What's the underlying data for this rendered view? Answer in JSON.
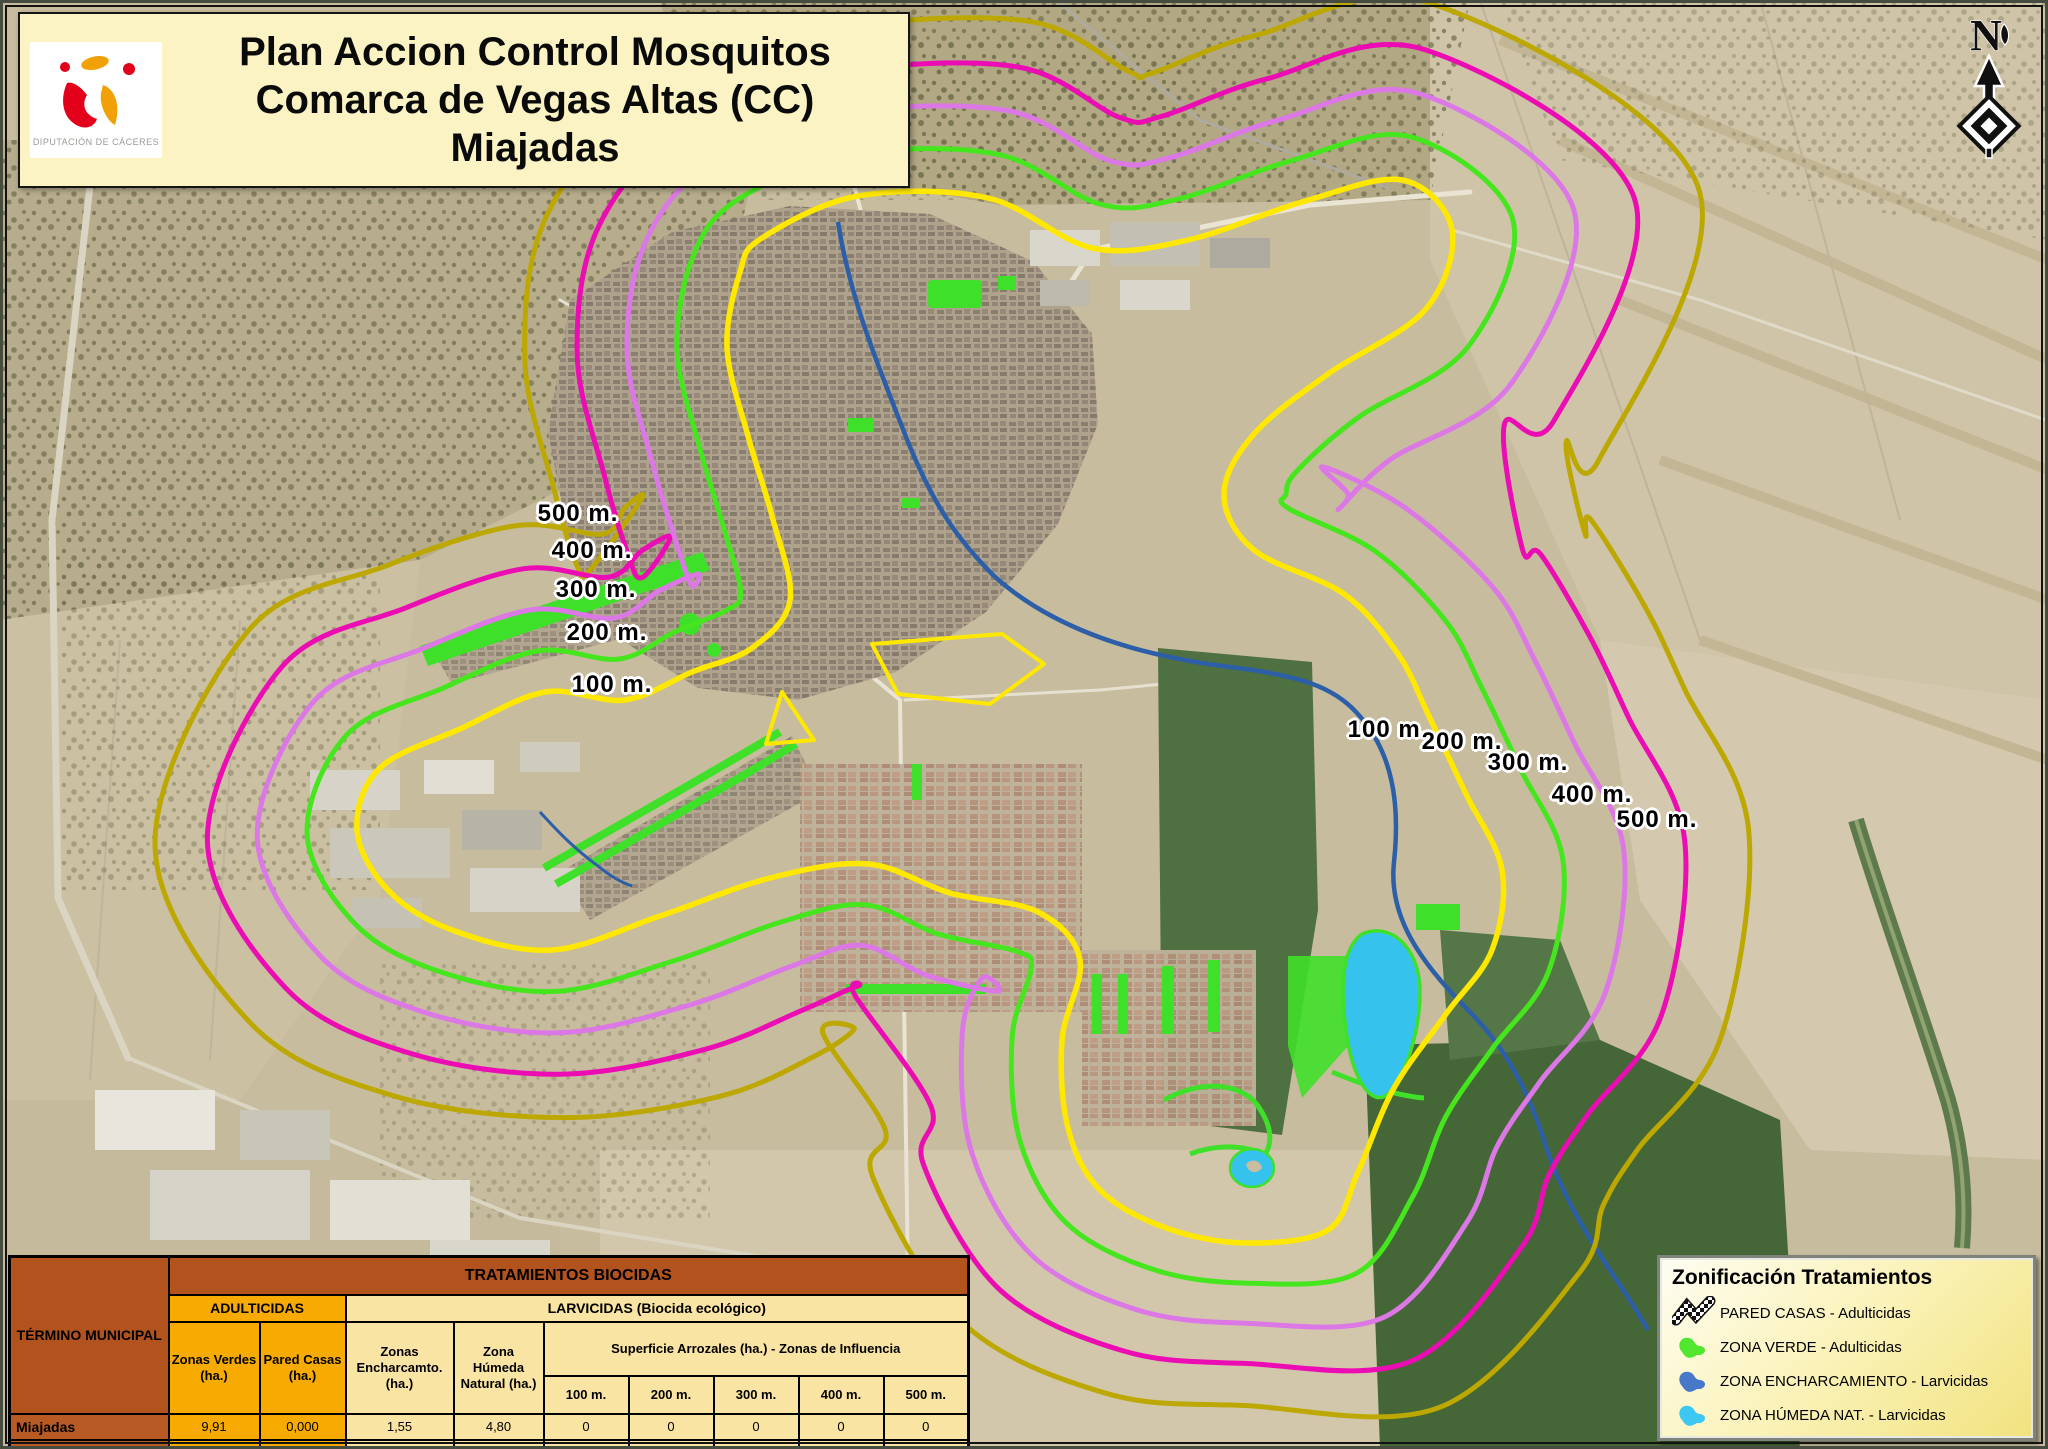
{
  "title_block": {
    "logo_caption": "DIPUTACIÓN DE CÁCERES",
    "line1": "Plan Accion Control Mosquitos",
    "line2": "Comarca de Vegas Altas (CC)",
    "line3": "Miajadas"
  },
  "north_arrow": {
    "label": "N"
  },
  "map": {
    "rings": [
      {
        "label": "100 m.",
        "color": "#FFE800",
        "offset": 0
      },
      {
        "label": "200 m.",
        "color": "#46E61E",
        "offset": 40
      },
      {
        "label": "300 m.",
        "color": "#DC78E6",
        "offset": 80
      },
      {
        "label": "400 m.",
        "color": "#EB0CB4",
        "offset": 120
      },
      {
        "label": "500 m.",
        "color": "#BCA800",
        "offset": 162
      }
    ],
    "left_labels": [
      "500 m.",
      "400 m.",
      "300 m.",
      "200 m.",
      "100 m."
    ],
    "right_labels": [
      "100 m.",
      "200 m.",
      "300 m.",
      "400 m.",
      "500 m."
    ],
    "features": {
      "river_color": "#2C5FA8",
      "lake_color": "#35C3EE",
      "green_zone_color": "#3FE02A"
    }
  },
  "legend": {
    "title": "Zonificación Tratamientos",
    "items": [
      {
        "icon": "checkered-flag-icon",
        "label": "PARED CASAS - Adulticidas",
        "color": "#111111"
      },
      {
        "icon": "green-zone-icon",
        "label": "ZONA VERDE - Adulticidas",
        "color": "#52E62E"
      },
      {
        "icon": "waterlogging-zone-icon",
        "label": "ZONA ENCHARCAMIENTO - Larvicidas",
        "color": "#4878C8"
      },
      {
        "icon": "wetland-zone-icon",
        "label": "ZONA HÚMEDA NAT. - Larvicidas",
        "color": "#3CC8F2"
      }
    ]
  },
  "table": {
    "row_header": "TÉRMINO MUNICIPAL",
    "main_header": "TRATAMIENTOS BIOCIDAS",
    "groups": {
      "adulticidas": "ADULTICIDAS",
      "larvicidas": "LARVICIDAS (Biocida ecológico)"
    },
    "columns": [
      "Zonas Verdes (ha.)",
      "Pared Casas (ha.)",
      "Zonas Encharcamto. (ha.)",
      "Zona Húmeda Natural (ha.)"
    ],
    "arrozales_header": "Superficie Arrozales (ha.) - Zonas de Influencia",
    "distance_columns": [
      "100 m.",
      "200 m.",
      "300 m.",
      "400 m.",
      "500 m."
    ],
    "rows": [
      {
        "municipality": "Miajadas",
        "values": [
          "9,91",
          "0,000",
          "1,55",
          "4,80",
          "0",
          "0",
          "0",
          "0",
          "0"
        ]
      }
    ]
  }
}
